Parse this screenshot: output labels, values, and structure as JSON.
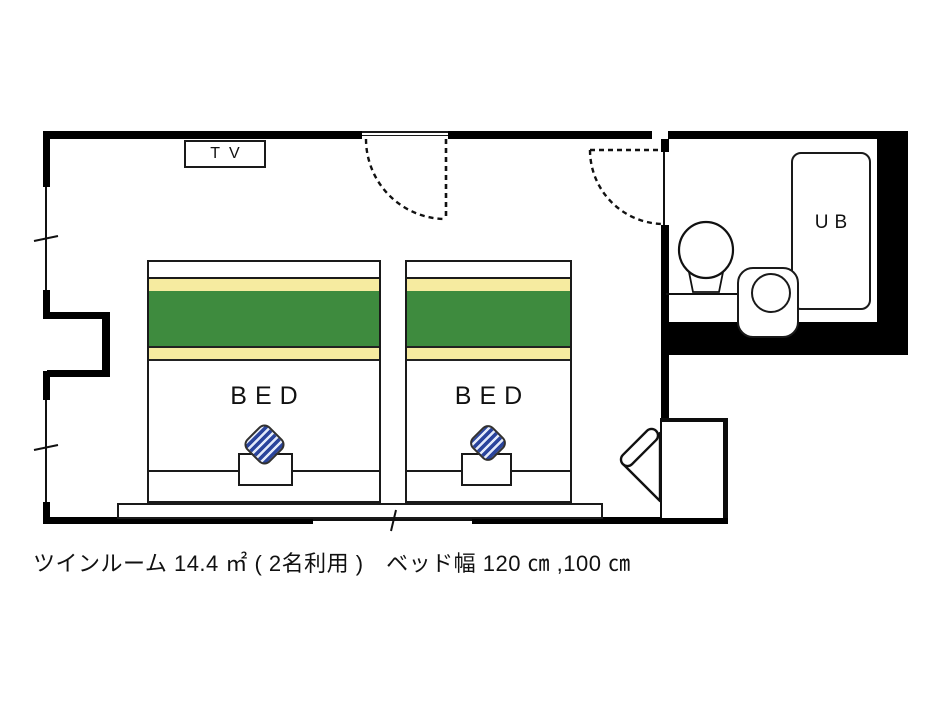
{
  "diagram": {
    "tv_label": "TV",
    "bath_unit_label": "UB",
    "beds": [
      {
        "label": "BED",
        "width_cm": "120"
      },
      {
        "label": "BED",
        "width_cm": "100"
      }
    ],
    "caption": "ツインルーム 14.4 ㎡ ( 2名利用 )　ベッド幅 120 ㎝ ,100 ㎝",
    "room_info": {
      "room_type": "ツインルーム",
      "area": "14.4 ㎡",
      "occupancy": "2名利用",
      "bed_widths": [
        "120 ㎝",
        "100 ㎝"
      ]
    },
    "colors": {
      "wall": "#000000",
      "bed_blanket_green": "#3e8b3e",
      "bed_stripe_yellow": "#f6eba0",
      "cushion_navy": "#2a449c",
      "cushion_light_stripe": "#e3eafa"
    }
  }
}
